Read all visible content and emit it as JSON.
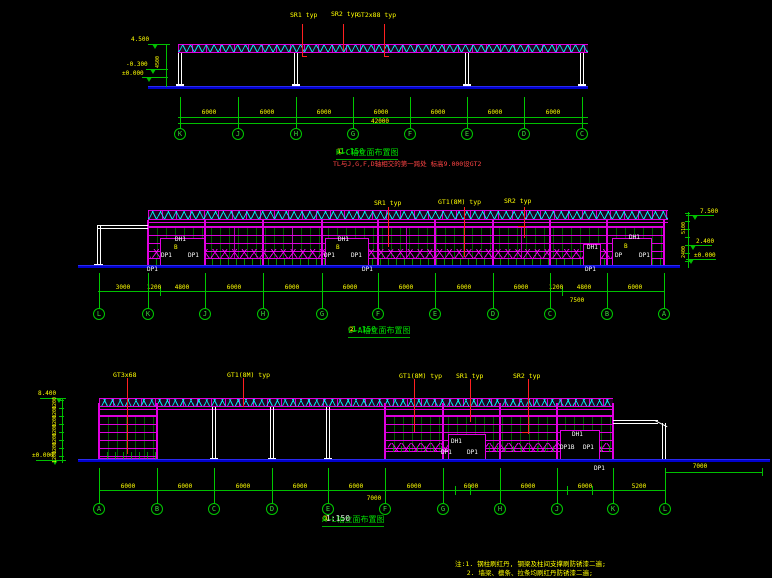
{
  "canvas": {
    "width": 772,
    "height": 578,
    "background": "#000000"
  },
  "palette": {
    "magenta": "#e000e0",
    "green": "#00c000",
    "yellow": "#ffff00",
    "cyan": "#00ffff",
    "ground_blue": "#0000cc",
    "leader_red": "#ff2020",
    "white": "#ffffff"
  },
  "top_elevation": {
    "component_labels": [
      {
        "text": "SR1 typ",
        "x": 290,
        "y": 11
      },
      {
        "text": "SR2 typ",
        "x": 331,
        "y": 10
      },
      {
        "text": "GT2x88 typ",
        "x": 357,
        "y": 11
      }
    ],
    "levels": [
      {
        "text": "4.500",
        "x": 131,
        "y": 36
      },
      {
        "text": "-0.300",
        "x": 126,
        "y": 61
      },
      {
        "text": "±0.000",
        "x": 122,
        "y": 70
      }
    ],
    "vertical_dims": [
      {
        "text": "4500",
        "x": 155,
        "y": 68
      }
    ],
    "bay_dims": [
      {
        "text": "6000",
        "x": 209,
        "y": 109
      },
      {
        "text": "6000",
        "x": 267,
        "y": 109
      },
      {
        "text": "6000",
        "x": 324,
        "y": 109
      },
      {
        "text": "6000",
        "x": 381,
        "y": 109
      },
      {
        "text": "6000",
        "x": 438,
        "y": 109
      },
      {
        "text": "6000",
        "x": 495,
        "y": 109
      },
      {
        "text": "6000",
        "x": 553,
        "y": 109
      }
    ],
    "total_dim": {
      "text": "42000",
      "x": 380,
      "y": 118
    },
    "grid_bubbles": [
      {
        "label": "K",
        "x": 180
      },
      {
        "label": "J",
        "x": 238
      },
      {
        "label": "H",
        "x": 296
      },
      {
        "label": "G",
        "x": 353
      },
      {
        "label": "F",
        "x": 410
      },
      {
        "label": "E",
        "x": 467
      },
      {
        "label": "D",
        "x": 524
      },
      {
        "label": "C",
        "x": 582
      }
    ],
    "title": {
      "badge": "①",
      "text": "K~C轴立面布置图",
      "scale": "1:150"
    },
    "note": "TL与J,G,F,D轴相交的第一跨处 标高9.000设GT2"
  },
  "middle_elevation": {
    "component_labels": [
      {
        "text": "SR1 typ",
        "x": 374,
        "y": 199
      },
      {
        "text": "GT1(8M) typ",
        "x": 438,
        "y": 198
      },
      {
        "text": "SR2 typ",
        "x": 504,
        "y": 197
      }
    ],
    "door_labels": [
      {
        "text": "DH1",
        "x": 175,
        "y": 236
      },
      {
        "text": "DP1",
        "x": 161,
        "y": 252
      },
      {
        "text": "DP1",
        "x": 188,
        "y": 252
      },
      {
        "text": "DP1",
        "x": 147,
        "y": 266
      },
      {
        "text": "DH1",
        "x": 338,
        "y": 236
      },
      {
        "text": "DP1",
        "x": 324,
        "y": 252
      },
      {
        "text": "DP1",
        "x": 351,
        "y": 252
      },
      {
        "text": "DP1",
        "x": 362,
        "y": 266
      },
      {
        "text": "DH1",
        "x": 629,
        "y": 234
      },
      {
        "text": "DP",
        "x": 615,
        "y": 252
      },
      {
        "text": "DP1",
        "x": 639,
        "y": 252
      },
      {
        "text": "DH1",
        "x": 587,
        "y": 244
      },
      {
        "text": "DP1",
        "x": 585,
        "y": 266
      }
    ],
    "door_sublabels": [
      {
        "text": "B",
        "x": 174,
        "y": 244
      },
      {
        "text": "B",
        "x": 336,
        "y": 244
      },
      {
        "text": "B",
        "x": 624,
        "y": 243
      }
    ],
    "levels": [
      {
        "text": "7.500",
        "x": 700,
        "y": 208
      },
      {
        "text": "2.400",
        "x": 696,
        "y": 238
      },
      {
        "text": "±0.000",
        "x": 694,
        "y": 252
      }
    ],
    "vertical_dims": [
      {
        "text": "5100",
        "x": 681,
        "y": 234
      },
      {
        "text": "2400",
        "x": 681,
        "y": 258
      }
    ],
    "bay_dims": [
      {
        "text": "3000",
        "x": 123,
        "y": 284
      },
      {
        "text": "1200",
        "x": 154,
        "y": 284
      },
      {
        "text": "4800",
        "x": 182,
        "y": 284
      },
      {
        "text": "6000",
        "x": 234,
        "y": 284
      },
      {
        "text": "6000",
        "x": 292,
        "y": 284
      },
      {
        "text": "6000",
        "x": 350,
        "y": 284
      },
      {
        "text": "6000",
        "x": 406,
        "y": 284
      },
      {
        "text": "6000",
        "x": 464,
        "y": 284
      },
      {
        "text": "6000",
        "x": 521,
        "y": 284
      },
      {
        "text": "1200",
        "x": 556,
        "y": 284
      },
      {
        "text": "4800",
        "x": 584,
        "y": 284
      },
      {
        "text": "6000",
        "x": 635,
        "y": 284
      }
    ],
    "total_dim": {
      "text": "7500",
      "x": 577,
      "y": 297
    },
    "grid_bubbles": [
      {
        "label": "L",
        "x": 99
      },
      {
        "label": "K",
        "x": 148
      },
      {
        "label": "J",
        "x": 205
      },
      {
        "label": "H",
        "x": 263
      },
      {
        "label": "G",
        "x": 322
      },
      {
        "label": "F",
        "x": 378
      },
      {
        "label": "E",
        "x": 435
      },
      {
        "label": "D",
        "x": 493
      },
      {
        "label": "C",
        "x": 550
      },
      {
        "label": "B",
        "x": 607
      },
      {
        "label": "A",
        "x": 664
      }
    ],
    "title": {
      "badge": "②",
      "text": "L~A轴立面布置图",
      "scale": "1:150"
    }
  },
  "bottom_elevation": {
    "component_labels": [
      {
        "text": "GT3x68",
        "x": 113,
        "y": 371
      },
      {
        "text": "GT1(8M) typ",
        "x": 227,
        "y": 371
      },
      {
        "text": "GT1(8M) typ",
        "x": 399,
        "y": 372
      },
      {
        "text": "SR1 typ",
        "x": 456,
        "y": 372
      },
      {
        "text": "SR2 typ",
        "x": 513,
        "y": 372
      }
    ],
    "door_labels": [
      {
        "text": "DH1",
        "x": 451,
        "y": 438
      },
      {
        "text": "DP1",
        "x": 441,
        "y": 449
      },
      {
        "text": "DP1",
        "x": 467,
        "y": 449
      },
      {
        "text": "DH1",
        "x": 572,
        "y": 431
      },
      {
        "text": "DP1B",
        "x": 560,
        "y": 444
      },
      {
        "text": "DP1",
        "x": 583,
        "y": 444
      },
      {
        "text": "DP1",
        "x": 594,
        "y": 465
      }
    ],
    "levels": [
      {
        "text": "8.400",
        "x": 38,
        "y": 390
      },
      {
        "text": "±0.000",
        "x": 32,
        "y": 452
      }
    ],
    "vertical_dims": [
      {
        "text": "1200",
        "x": 52,
        "y": 409
      },
      {
        "text": "1200",
        "x": 52,
        "y": 418
      },
      {
        "text": "1200",
        "x": 52,
        "y": 427
      },
      {
        "text": "1200",
        "x": 52,
        "y": 436
      },
      {
        "text": "1200",
        "x": 52,
        "y": 445
      },
      {
        "text": "1200",
        "x": 52,
        "y": 454
      },
      {
        "text": "1200",
        "x": 52,
        "y": 463
      }
    ],
    "bay_dims": [
      {
        "text": "6000",
        "x": 128,
        "y": 483
      },
      {
        "text": "6000",
        "x": 185,
        "y": 483
      },
      {
        "text": "6000",
        "x": 243,
        "y": 483
      },
      {
        "text": "6000",
        "x": 300,
        "y": 483
      },
      {
        "text": "6000",
        "x": 356,
        "y": 483
      },
      {
        "text": "6000",
        "x": 414,
        "y": 483
      },
      {
        "text": "6000",
        "x": 471,
        "y": 483
      },
      {
        "text": "6000",
        "x": 528,
        "y": 483
      },
      {
        "text": "6000",
        "x": 585,
        "y": 483
      },
      {
        "text": "5200",
        "x": 639,
        "y": 483
      }
    ],
    "total_dim": {
      "text": "7000",
      "x": 374,
      "y": 495
    },
    "canopy_dim": {
      "text": "7000",
      "x": 700,
      "y": 463
    },
    "grid_bubbles": [
      {
        "label": "A",
        "x": 99
      },
      {
        "label": "B",
        "x": 157
      },
      {
        "label": "C",
        "x": 214
      },
      {
        "label": "D",
        "x": 272
      },
      {
        "label": "E",
        "x": 328
      },
      {
        "label": "F",
        "x": 385
      },
      {
        "label": "G",
        "x": 443
      },
      {
        "label": "H",
        "x": 500
      },
      {
        "label": "J",
        "x": 557
      },
      {
        "label": "K",
        "x": 613
      },
      {
        "label": "L",
        "x": 665
      }
    ],
    "title": {
      "badge": "③",
      "text": "A~L轴立面布置图",
      "scale": "1:150"
    }
  },
  "general_notes": {
    "lines": [
      "注:1. 钢柱刷红丹, 钢梁及柱间支撑刷防锈漆二遍;",
      "   2. 墙梁、檩条、拉条均刷红丹防锈漆二遍;",
      "   3. 图中H-L轴间门式钢架连接详图见结施图."
    ]
  }
}
